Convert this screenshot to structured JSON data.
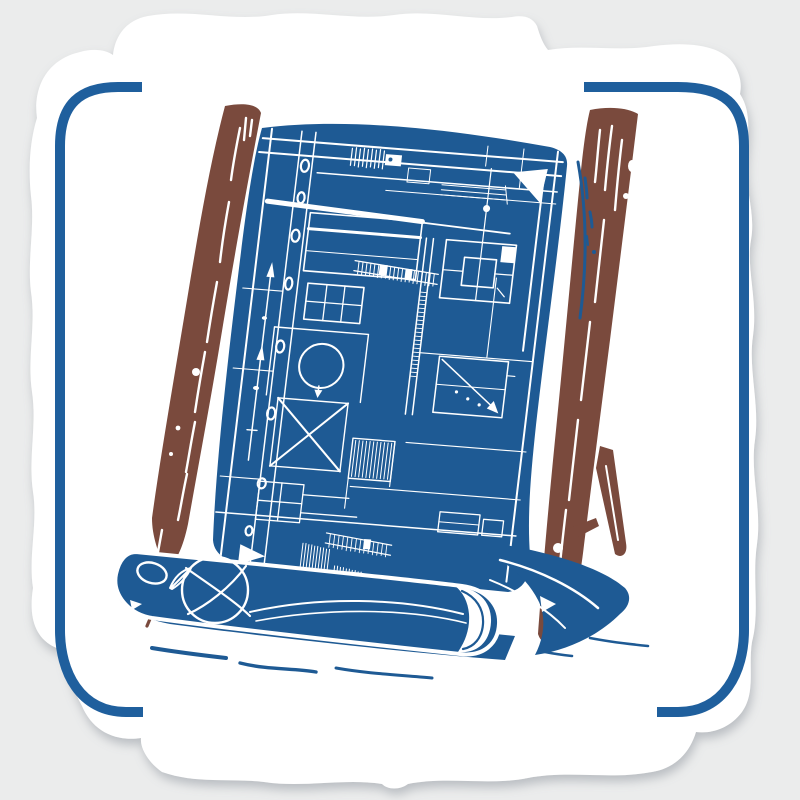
{
  "meta": {
    "alt": "Die-cut sticker showing an architectural blueprint sheet with white plan lines, held on two wooden easel rails, its lower edge rolled up, inside a blue rounded-rectangle border frame"
  },
  "scene": {
    "colors": {
      "bg": "#ebecec",
      "sticker": "#ffffff",
      "frame": "#1f5f9d",
      "blueprint": "#1e5a94",
      "line": "#ffffff",
      "wood": "#7a4a3d"
    }
  }
}
